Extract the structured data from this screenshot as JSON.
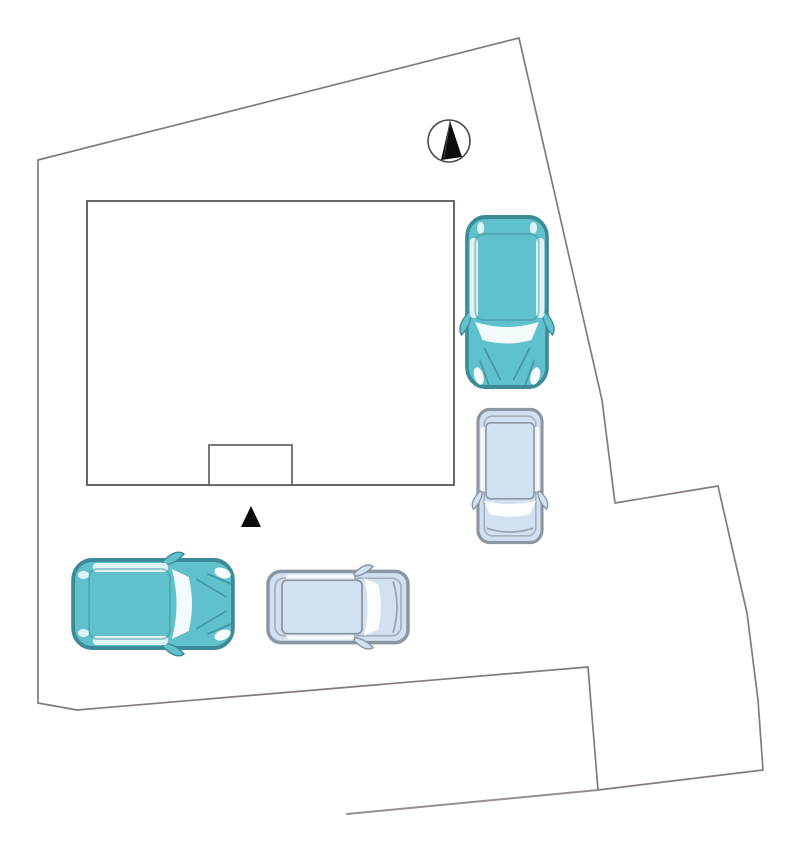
{
  "page": {
    "type": "residential-site-plan-diagram",
    "background": "#ffffff"
  },
  "colors": {
    "boundary_line": "#847a7c",
    "road_line": "#9b8d8f",
    "building_line": "#5d5456",
    "building_fill": "#ffffff",
    "car_teal_body": "#5fc1cb",
    "car_teal_outline": "#3d8b99",
    "van_blue_body": "#d2e1f2",
    "van_blue_outline": "#8b96a3",
    "glass_white": "#ffffff",
    "marker_black": "#0c0c0c",
    "compass_ring": "#4a4a4a",
    "compass_needle": "#0c0c0c"
  },
  "plan": {
    "site": "irregular-parcel-boundary",
    "building": "building-footprint",
    "porch": "entrance-porch",
    "entrance_marker": "entrance-triangle",
    "compass": "north-arrow",
    "cars": [
      {
        "id": "car-1",
        "type": "hatchback",
        "color_name": "teal",
        "orientation": "vertical",
        "facing": "down",
        "location": "upper-right-parking"
      },
      {
        "id": "car-2",
        "type": "van",
        "color_name": "light-blue",
        "orientation": "vertical",
        "facing": "down",
        "location": "right-parking"
      },
      {
        "id": "car-3",
        "type": "hatchback",
        "color_name": "teal",
        "orientation": "horizontal",
        "facing": "right",
        "location": "lower-left-parking"
      },
      {
        "id": "car-4",
        "type": "van",
        "color_name": "light-blue",
        "orientation": "horizontal",
        "facing": "right",
        "location": "lower-middle-parking"
      }
    ]
  }
}
